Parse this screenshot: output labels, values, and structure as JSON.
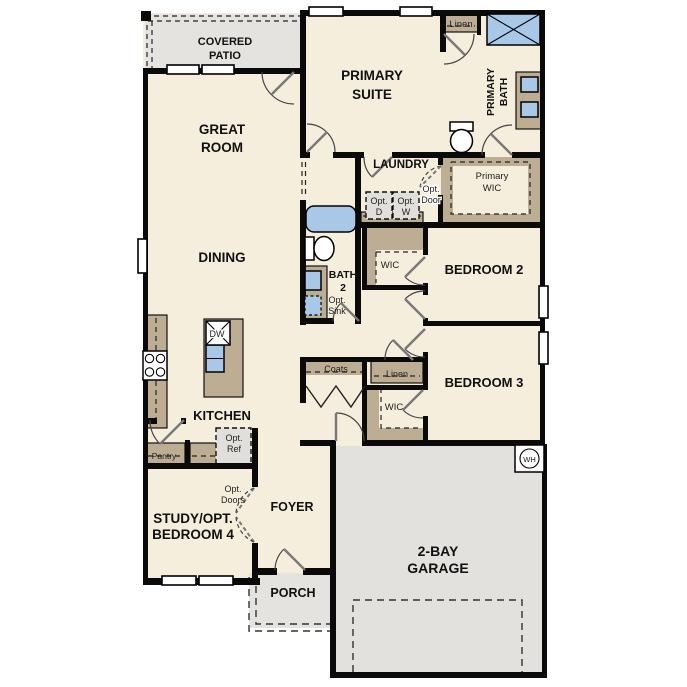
{
  "rooms": {
    "covered_patio": {
      "l1": "COVERED",
      "l2": "PATIO"
    },
    "great_room": {
      "l1": "GREAT",
      "l2": "ROOM"
    },
    "primary_suite": {
      "l1": "PRIMARY",
      "l2": "SUITE"
    },
    "primary_bath": {
      "l1": "PRIMARY",
      "l2": "BATH"
    },
    "linen_upper": "Linen",
    "laundry": "LAUNDRY",
    "primary_wic": {
      "l1": "Primary",
      "l2": "WIC"
    },
    "dining": "DINING",
    "bath_2": {
      "l1": "BATH",
      "l2": "2"
    },
    "wic_bed2": "WIC",
    "bedroom_2": "BEDROOM 2",
    "kitchen": "KITCHEN",
    "pantry": "Pantry",
    "coats": "Coats",
    "linen_hall": "Linen",
    "wic_bed3": "WIC",
    "bedroom_3": "BEDROOM 3",
    "foyer": "FOYER",
    "study": {
      "l1": "STUDY/OPT.",
      "l2": "BEDROOM 4"
    },
    "porch": "PORCH",
    "garage": {
      "l1": "2-BAY",
      "l2": "GARAGE"
    }
  },
  "options": {
    "dryer": {
      "l1": "Opt.",
      "l2": "D"
    },
    "washer": {
      "l1": "Opt.",
      "l2": "W"
    },
    "door": {
      "l1": "Opt.",
      "l2": "Door"
    },
    "sink": {
      "l1": "Opt.",
      "l2": "Sink"
    },
    "fridge": {
      "l1": "Opt.",
      "l2": "Ref"
    },
    "doors": {
      "l1": "Opt.",
      "l2": "Doors"
    }
  },
  "appliances": {
    "dishwasher": "DW",
    "water_heater": "WH"
  },
  "colors": {
    "wall": "#0a0a0a",
    "floor": "#f6eedd",
    "patio_gray": "#e4e3e0",
    "garage_gray": "#e2e1de",
    "cabinet_tan": "#bdae93",
    "fixture_blue": "#a9c8e8",
    "option_gray": "#e0dfdc",
    "paper": "#ffffff"
  }
}
